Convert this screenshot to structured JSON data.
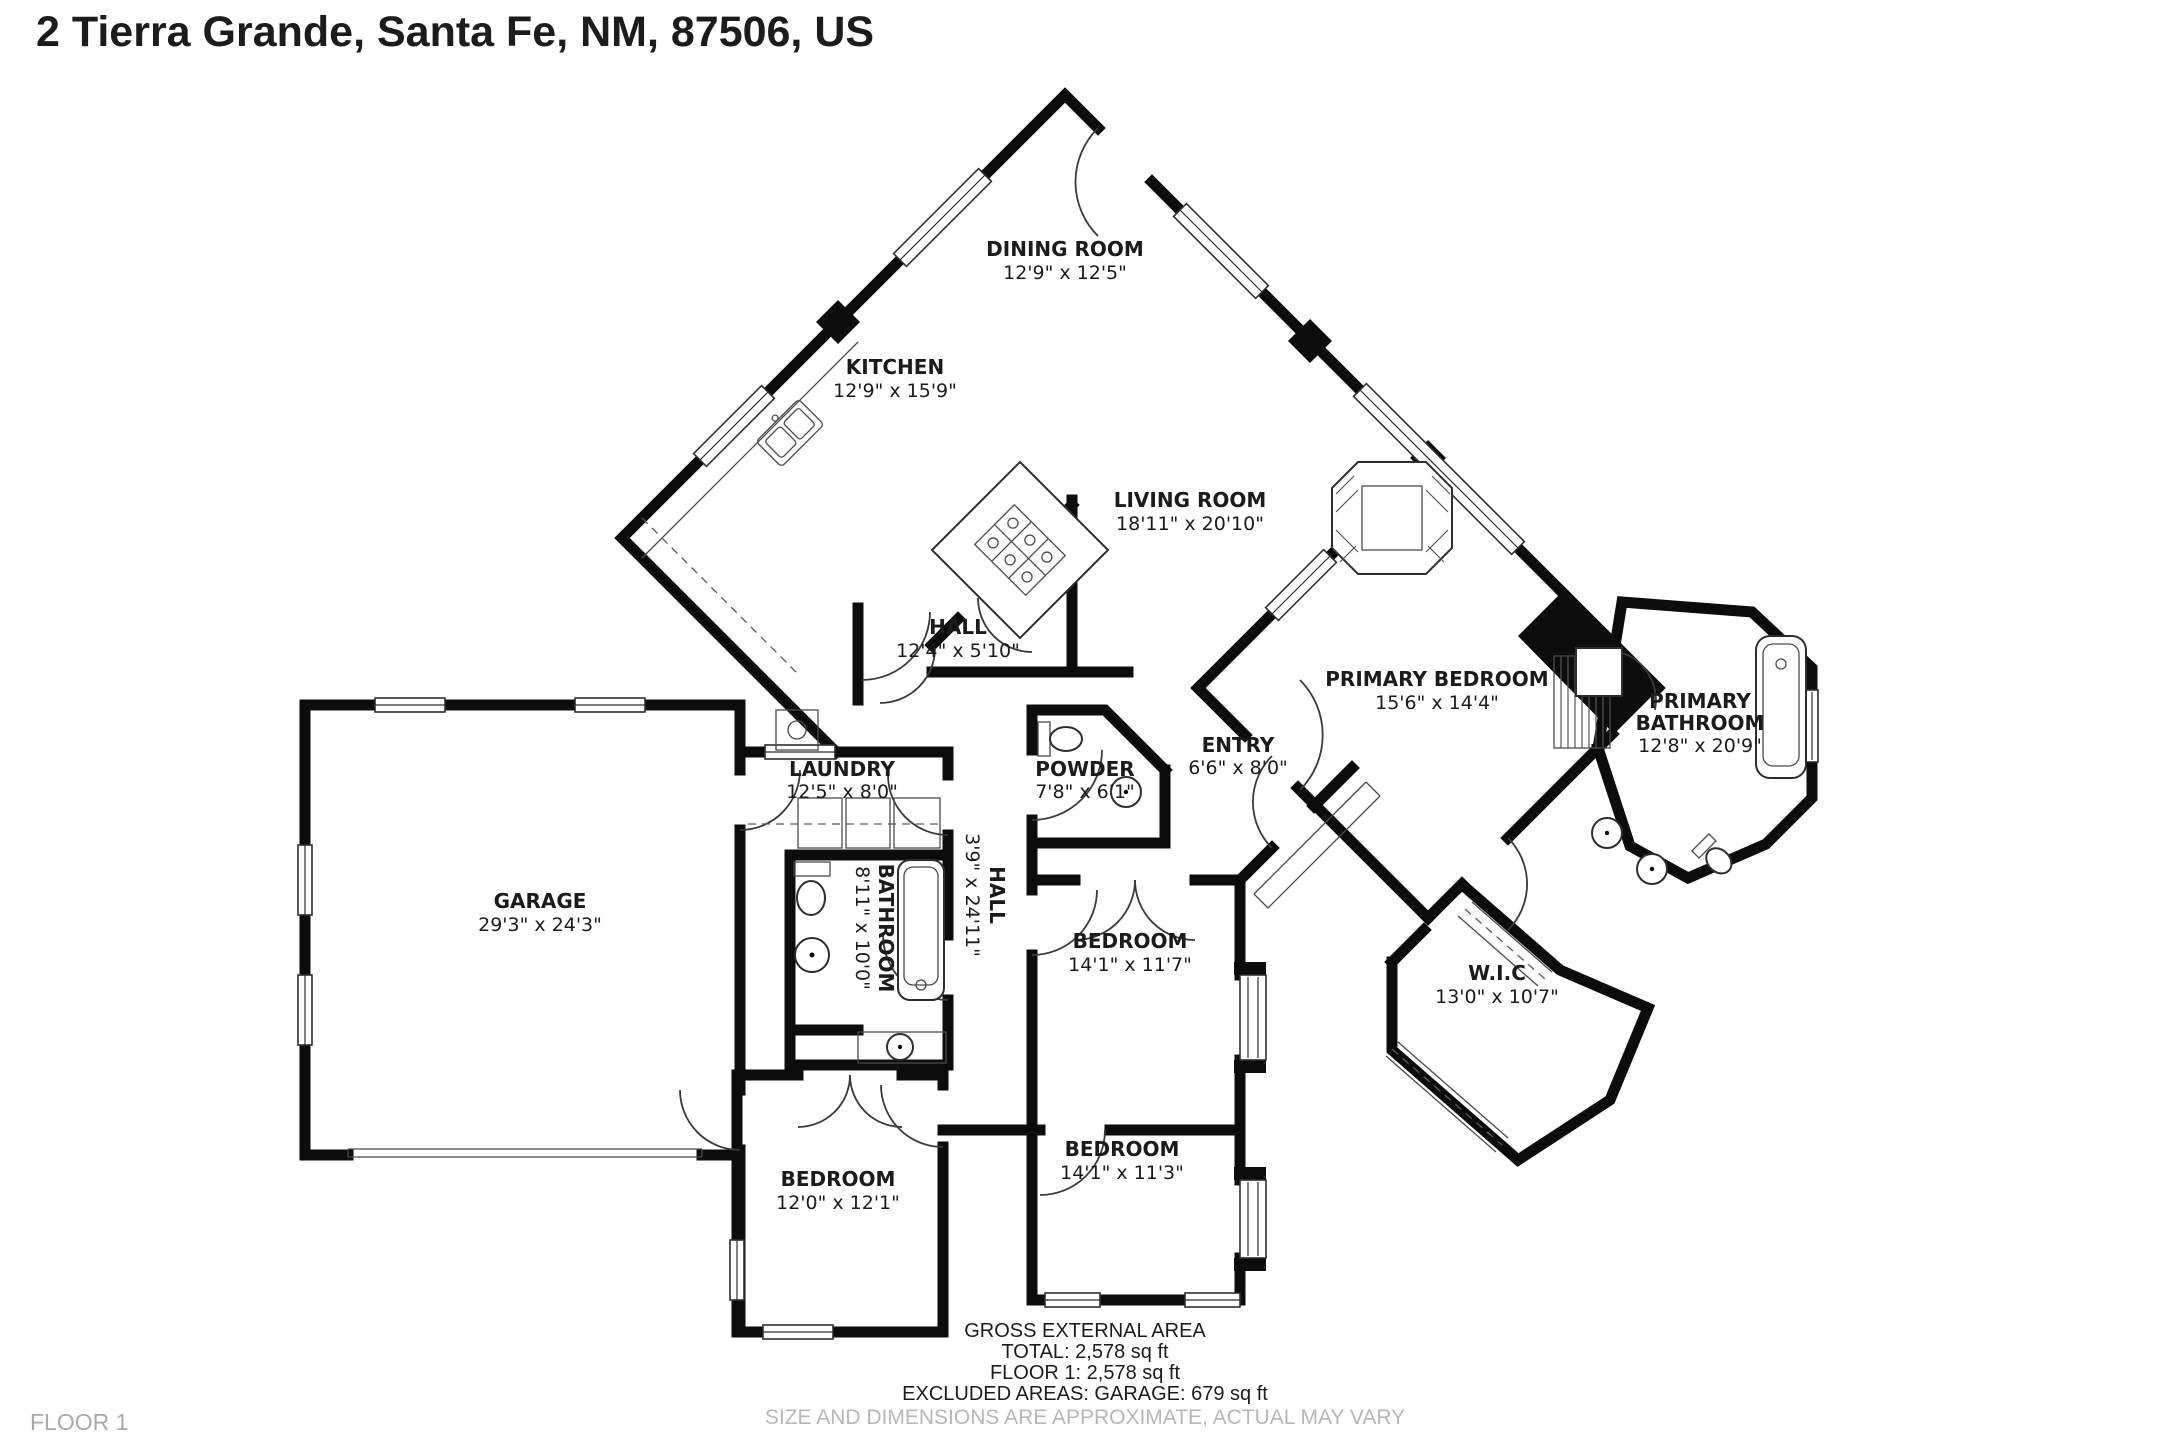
{
  "title": "2 Tierra Grande, Santa Fe, NM, 87506, US",
  "floor_tag": "FLOOR 1",
  "rooms": {
    "dining": {
      "name": "DINING ROOM",
      "dims": "12'9\" x 12'5\""
    },
    "kitchen": {
      "name": "KITCHEN",
      "dims": "12'9\" x 15'9\""
    },
    "living": {
      "name": "LIVING ROOM",
      "dims": "18'11\" x 20'10\""
    },
    "hall": {
      "name": "HALL",
      "dims": "12'4\" x 5'10\""
    },
    "laundry": {
      "name": "LAUNDRY",
      "dims": "12'5\" x 8'0\""
    },
    "powder": {
      "name": "POWDER",
      "dims": "7'8\" x 6'1\""
    },
    "entry": {
      "name": "ENTRY",
      "dims": "6'6\" x 8'0\""
    },
    "garage": {
      "name": "GARAGE",
      "dims": "29'3\" x 24'3\""
    },
    "bathroom": {
      "name": "BATHROOM",
      "dims": "8'11\" x 10'0\""
    },
    "hall2": {
      "name": "HALL",
      "dims": "3'9\" x 24'11\""
    },
    "bedroom_mid": {
      "name": "BEDROOM",
      "dims": "14'1\" x 11'7\""
    },
    "primary_bedroom": {
      "name": "PRIMARY BEDROOM",
      "dims": "15'6\" x 14'4\""
    },
    "primary_bathroom": {
      "line1": "PRIMARY",
      "line2": "BATHROOM",
      "dims": "12'8\" x 20'9\""
    },
    "wic": {
      "name": "W.I.C",
      "dims": "13'0\" x 10'7\""
    },
    "bedroom_bl": {
      "name": "BEDROOM",
      "dims": "12'0\" x 12'1\""
    },
    "bedroom_bm": {
      "name": "BEDROOM",
      "dims": "14'1\" x 11'3\""
    }
  },
  "footer": {
    "area_title": "GROSS EXTERNAL AREA",
    "total": "TOTAL: 2,578 sq ft",
    "floor1": "FLOOR 1: 2,578 sq ft",
    "excluded": "EXCLUDED AREAS: GARAGE: 679 sq ft",
    "disclaimer": "SIZE AND DIMENSIONS ARE APPROXIMATE, ACTUAL MAY VARY"
  },
  "colors": {
    "wall": "#0c0c0c",
    "label": "#1b1b1b",
    "muted": "#b7b7b7",
    "background": "#ffffff"
  }
}
